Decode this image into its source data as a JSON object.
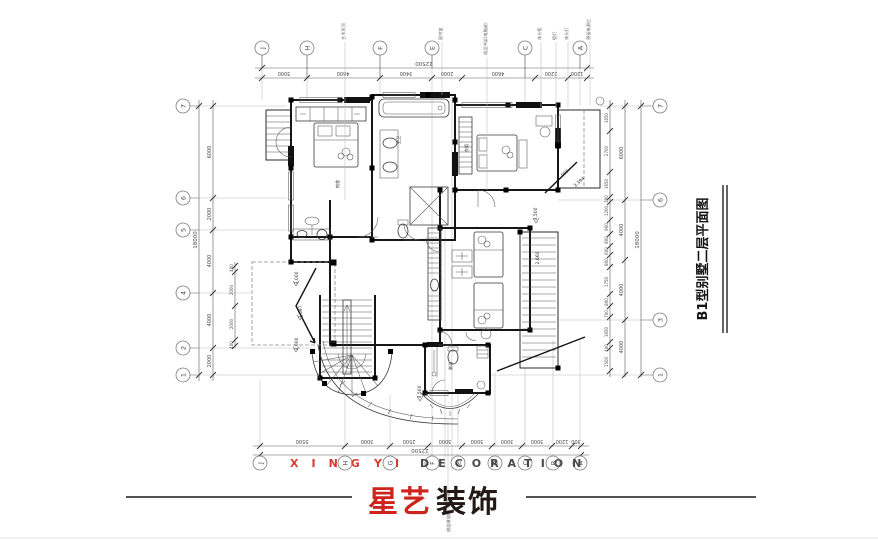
{
  "title": {
    "text": "B1型别墅二层平面图"
  },
  "logo": {
    "red": "星艺",
    "black": "装饰"
  },
  "watermark": {
    "xing": "XING",
    "yi": "YI",
    "decoration": "DECORATION"
  },
  "colors": {
    "brand_red": "#cf2a1d",
    "ink": "#1b1b1b",
    "dim_text": "#4a4a4a",
    "grid_gray": "#8a8a8a",
    "watermark_dark": "#45433f"
  },
  "grid": {
    "top": [
      "J",
      "H",
      "F",
      "E",
      "C",
      "A"
    ],
    "bottom": [
      "J",
      "H",
      "G",
      "F",
      "E",
      "D",
      "C",
      "B",
      "A"
    ],
    "left": [
      "7",
      "6",
      "5",
      "4",
      "2",
      "1"
    ],
    "right": [
      "7",
      "6",
      "3",
      "1"
    ]
  },
  "dims": {
    "top_total": "22500",
    "top_segments": [
      "3000",
      "4600",
      "3400",
      "2000",
      "4600",
      "2200",
      "1200"
    ],
    "bottom_total": "22500",
    "bottom_segments": [
      "5500",
      "3000",
      "2500",
      "3000",
      "3000",
      "3000",
      "3000",
      "1200",
      "300"
    ],
    "left_total": "18000",
    "left_segments": [
      "6000",
      "2000",
      "4000",
      "4000",
      "2000"
    ],
    "left_small": [
      "400",
      "2000",
      "2000",
      "400"
    ],
    "right_total": "18000",
    "right_mid": [
      "6000",
      "4000",
      "4000",
      "4000"
    ],
    "right_small": [
      "1650",
      "2700",
      "1650",
      "300",
      "1200",
      "900",
      "800",
      "600",
      "800",
      "1750",
      "800",
      "700",
      "1650",
      "400",
      "1500"
    ]
  },
  "elevations": {
    "terrace_top": "3.000",
    "terrace_mid": "3.697",
    "terrace_bottom": "3.000",
    "roof_top": "3.500",
    "roof_mid": "2.660",
    "bath_front": "3.500",
    "bed_offset": "900",
    "bed_diag": "3.394"
  },
  "annotations": {
    "a1": "艺术吊顶",
    "a2": "窗帘盒",
    "a3": "成品书架(电脑桌)",
    "a4": "床头柜",
    "a5": "壁灯",
    "a6": "床头灯",
    "a7": "预留电源位",
    "footer_note": "成品淋浴房(下层防水)"
  },
  "rooms": {
    "r1": "主卫",
    "r2": "梳妆",
    "r3": "淋浴",
    "r4": "衣柜"
  }
}
